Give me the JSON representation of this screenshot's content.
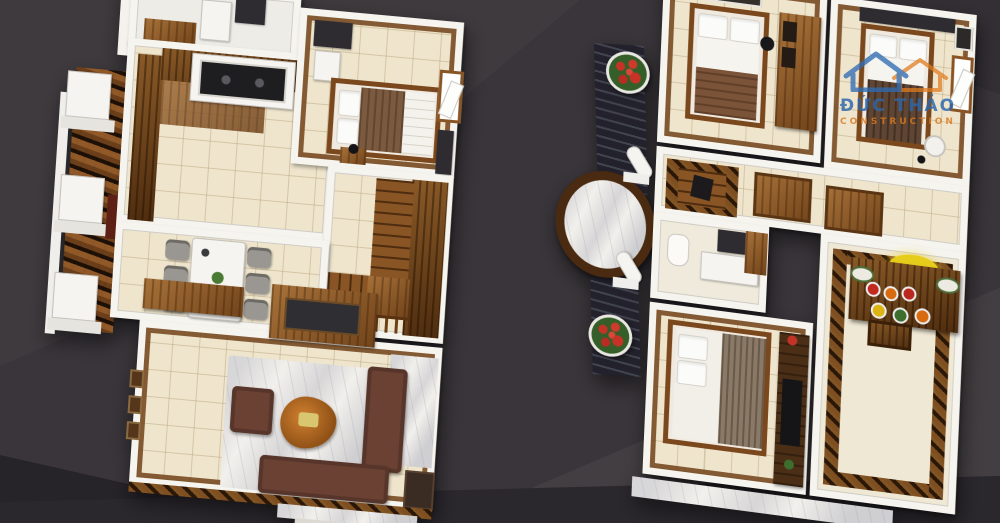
{
  "scene": {
    "type": "3d-floorplan-render",
    "background_color": "#39353a",
    "floors": [
      {
        "name": "first-floor",
        "position": "left",
        "rooms": [
          "utility-wc",
          "kitchen",
          "bedroom",
          "staircase",
          "dining-area",
          "living-room",
          "front-porch",
          "entry-steps"
        ],
        "furniture": [
          "kitchen-counter",
          "cooktop",
          "double-bed",
          "dining-table",
          "six-chairs",
          "sideboard",
          "altar-console",
          "sofa-set",
          "coffee-table",
          "area-rug",
          "tv-cabinet",
          "stone-pillars"
        ]
      },
      {
        "name": "second-floor",
        "position": "right",
        "rooms": [
          "bedroom-2",
          "master-bedroom",
          "hallway",
          "bathroom",
          "bedroom-3",
          "worship-room",
          "balcony",
          "terrace"
        ],
        "furniture": [
          "double-bed",
          "wardrobe",
          "picture-frame",
          "stairwell",
          "toilet",
          "vanity",
          "tv-console",
          "altar-table",
          "fruit-offerings",
          "flower-pots",
          "roof-panels",
          "marble-canopy",
          "columns"
        ]
      }
    ]
  },
  "watermark": {
    "title": "ĐỨC THẢO",
    "subtitle": "CONSTRUCTION",
    "title_color": "#2a66ad",
    "subtitle_color": "#d97a1f"
  },
  "palette": {
    "background": "#39353a",
    "wall_white": "#f6f4ef",
    "floor_tile": "#efe5cd",
    "wood_mid": "#8a5524",
    "wood_dark": "#6b3f16",
    "marble_light": "#f2f0ec",
    "marble_brown": "#46280e",
    "sofa_brown": "#6a4132",
    "coffee_table_orange": "#b06020",
    "roof_tiles": "#23222c",
    "flowers_red": "#c63326",
    "altar_gold": "#e7cd1b"
  }
}
